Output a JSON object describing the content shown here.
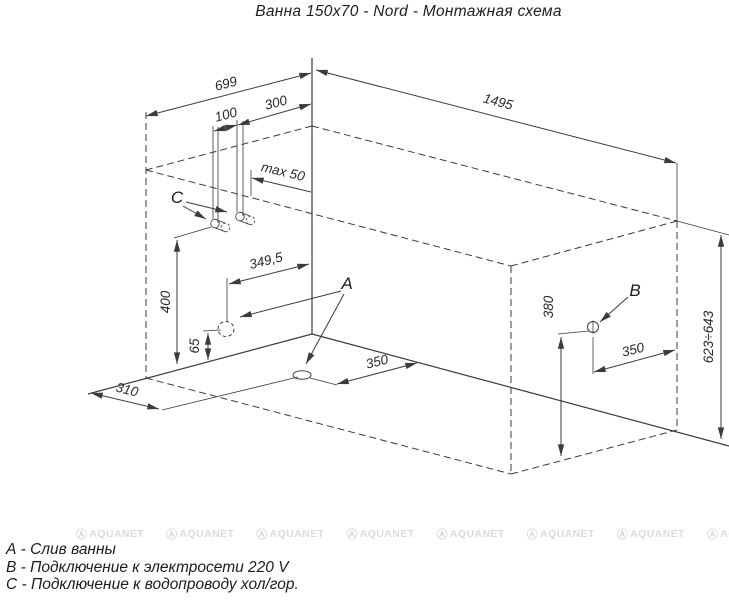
{
  "title": "Ванна 150x70 - Nord - Монтажная схема",
  "legend": {
    "item_a": "А - Слив ванны",
    "item_b": "В - Подключение к электросети 220 V",
    "item_c": "С - Подключение к водопроводу хол/гор."
  },
  "point_labels": {
    "a": "A",
    "b": "B",
    "c": "C"
  },
  "dimensions": {
    "tub_width": "699",
    "pipes_offset_from_corner": "300",
    "pipes_spacing": "100",
    "pipe_protrusion": "max 50",
    "tub_length": "1495",
    "wall_hole_offset": "349,5",
    "pipes_height": "400",
    "wall_hole_height": "65",
    "drain_offset_left_wall": "310",
    "drain_offset_right_wall": "350",
    "socket_height": "380",
    "socket_offset": "350",
    "rim_height_range": "623÷643"
  },
  "watermark": {
    "text": "AQUANET"
  },
  "colors": {
    "line": "#3b3b3b",
    "watermark": "#d8dbdf"
  }
}
